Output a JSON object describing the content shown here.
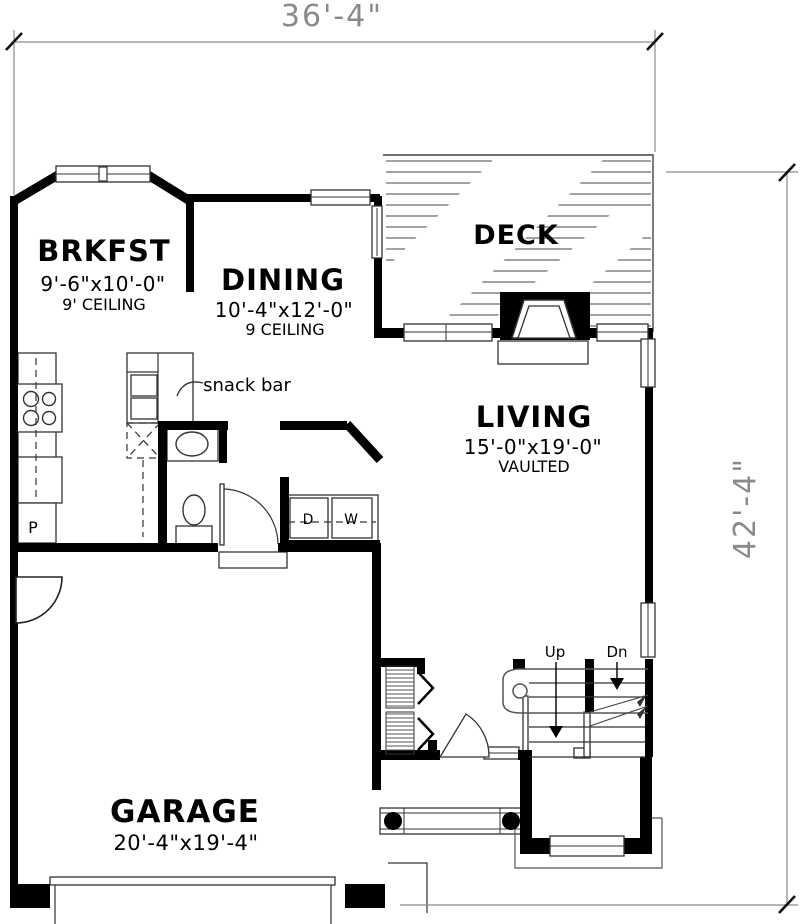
{
  "plan_title": "First floor plan",
  "dimensions": {
    "width": {
      "label": "36'-4\""
    },
    "height": {
      "label": "42'-4\""
    }
  },
  "rooms": {
    "brkfst": {
      "name": "BRKFST",
      "size": "9'-6\"x10'-0\"",
      "ceiling": "9' CEILING"
    },
    "dining": {
      "name": "DINING",
      "size": "10'-4\"x12'-0\"",
      "ceiling": "9 CEILING"
    },
    "deck": {
      "name": "DECK"
    },
    "living": {
      "name": "LIVING",
      "size": "15'-0\"x19'-0\"",
      "note": "VAULTED"
    },
    "garage": {
      "name": "GARAGE",
      "size": "20'-4\"x19'-4\""
    }
  },
  "fixtures": {
    "snack_bar": "snack bar",
    "pantry": "P",
    "dryer": "D",
    "washer": "W",
    "stairs_up": "Up",
    "stairs_down": "Dn"
  },
  "colors": {
    "wall": "#000000",
    "thin_line": "#3a3a3a",
    "hatch": "#6b6b6b",
    "dimension": "#8a8a8a",
    "background": "#ffffff"
  }
}
